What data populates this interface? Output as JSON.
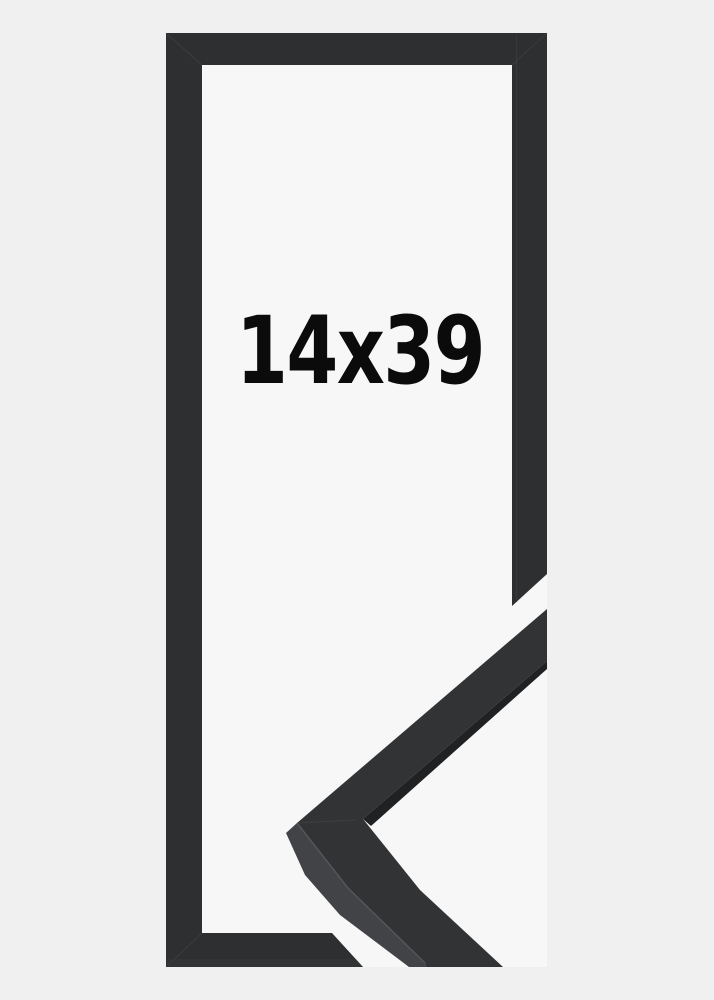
{
  "product_image": {
    "size_label": "14x39",
    "label_color": "#0b0b0c",
    "colors": {
      "background": "#f0f0f1",
      "opening": "#f7f7f8",
      "frame": "#2e2f30",
      "sample_face": "#323334",
      "sample_side": "#424346",
      "sample_edge_strip": "#202122",
      "arris_highlight": "#5a5b5e",
      "seam": "#4a4b4d",
      "lip_line": "#3c3d3f",
      "bottom_strip": "#3a3b3d"
    }
  }
}
